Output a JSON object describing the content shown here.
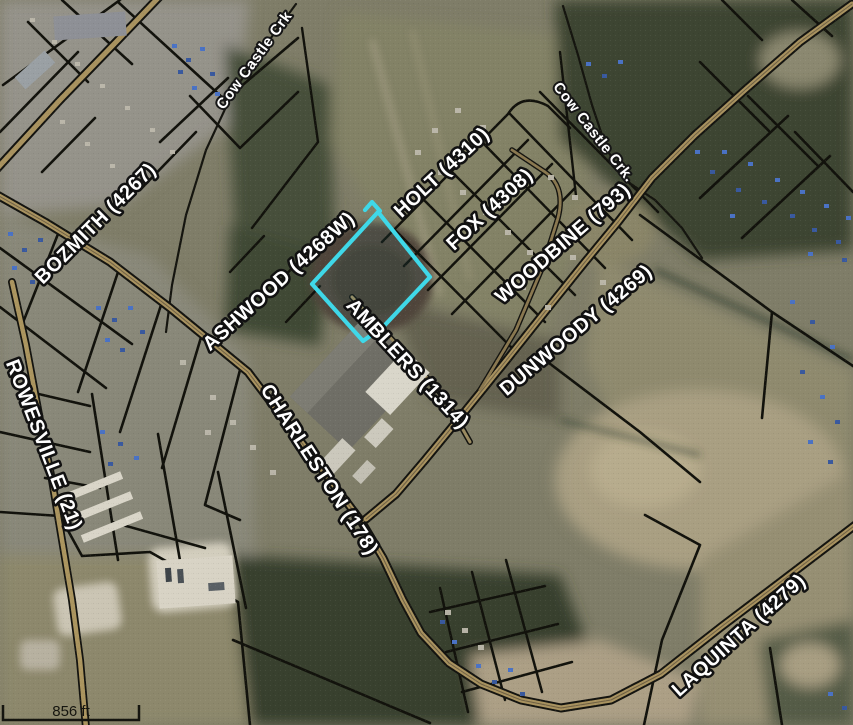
{
  "map": {
    "road_labels": [
      {
        "id": "bozmith",
        "text": "BOZMITH (4267)"
      },
      {
        "id": "rowesville",
        "text": "ROWESVILLE (21)"
      },
      {
        "id": "ashwood",
        "text": "ASHWOOD (4268W)"
      },
      {
        "id": "holt",
        "text": "HOLT (4310)"
      },
      {
        "id": "fox",
        "text": "FOX (4308)"
      },
      {
        "id": "woodbine",
        "text": "WOODBINE (793)"
      },
      {
        "id": "dunwoody",
        "text": "DUNWOODY (4269)"
      },
      {
        "id": "amblers",
        "text": "AMBLERS (1314)"
      },
      {
        "id": "charleston",
        "text": "CHARLESTON (178)"
      },
      {
        "id": "laquinta",
        "text": "LAQUINTA (4279)"
      }
    ],
    "water_labels": [
      {
        "id": "cow-castle-crk-north",
        "text": "Cow Castle Crk"
      },
      {
        "id": "cow-castle-crk-east",
        "text": "Cow Castle Crk."
      }
    ],
    "scale_bar": {
      "label": "856 ft"
    },
    "highlight_parcel": {
      "outline_color": "#3FD8E8"
    },
    "colors": {
      "road_fill": "#A8925F",
      "parcel_line": "#12120C",
      "label_text": "#FFFFFF",
      "label_outline": "#111111"
    }
  }
}
